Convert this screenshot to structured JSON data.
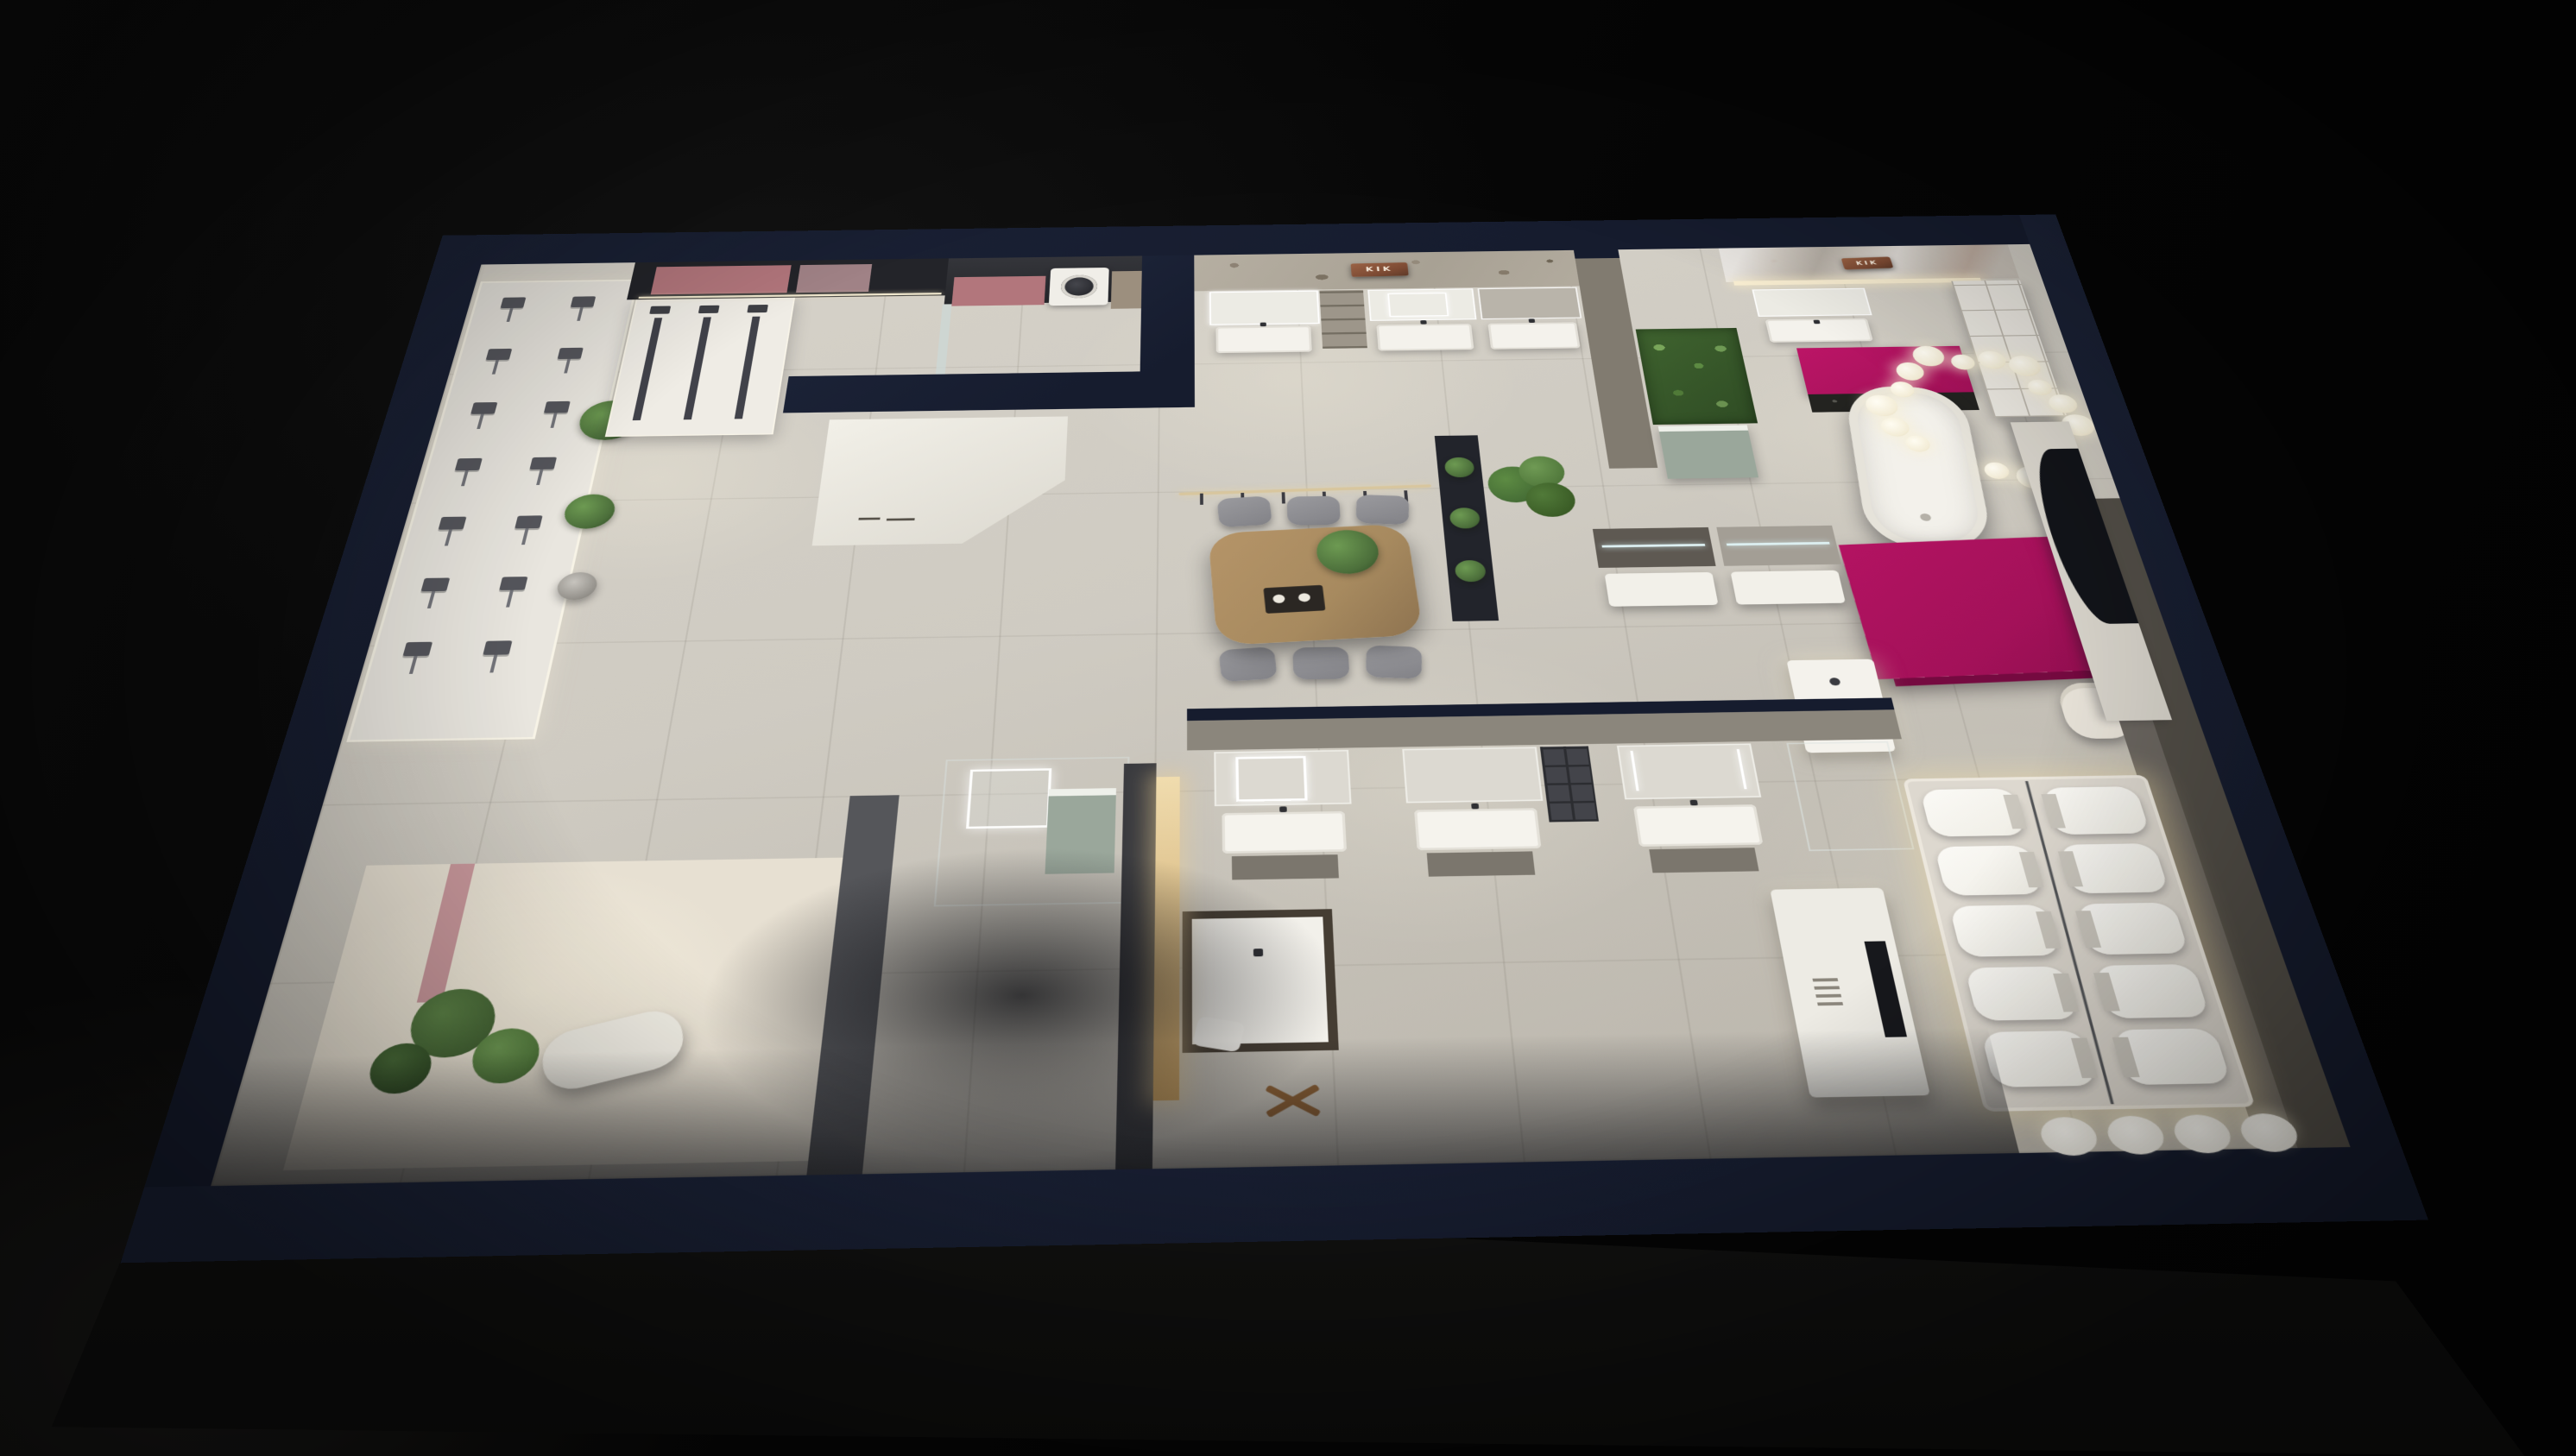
{
  "scene": {
    "type": "3d-render",
    "description": "Night-time aerial dollhouse view of a bathroom-fixture showroom",
    "brand": "KIK"
  },
  "signs": {
    "stone_wall": {
      "text": "KIK"
    },
    "marble_wall": {
      "text": "KIK"
    }
  },
  "palette": {
    "background": "#060606",
    "wall_navy": "#161c2e",
    "floor": "#cfcbc2",
    "accent_magenta": "#a31159",
    "sign_copper": "#7c4a33",
    "pink_cabinet": "#b2767c",
    "sage_green": "#9aa79b",
    "plant_green": "#4c6f3b",
    "wood": "#a78a5f",
    "warm_glow": "#ecdcae"
  },
  "fixtures": {
    "shower_wall_stations": 7,
    "shower_wall_columns": 2,
    "display_shower_columns": 3,
    "vanity_units_far_wall": 3,
    "vanity_units_bottom_row": 3,
    "meeting_chairs_per_side": 3,
    "pendant_hooks": 6,
    "chandelier_bulbs": 16,
    "toilet_rows": 5,
    "toilet_columns": 2,
    "rear_wall_basins": 4
  }
}
